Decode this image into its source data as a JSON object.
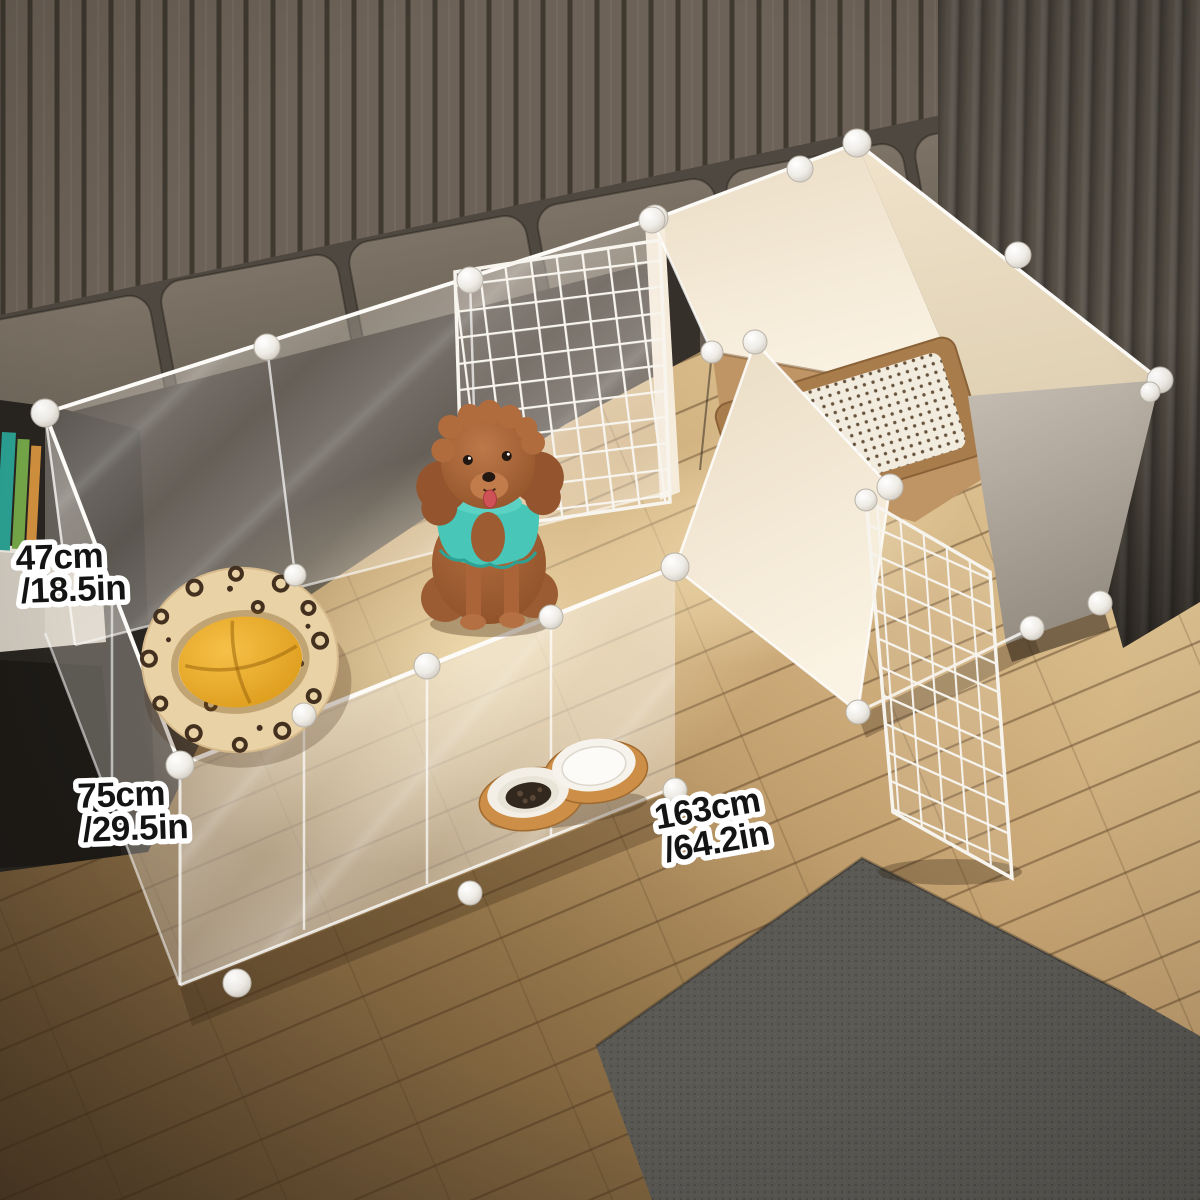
{
  "annotations": {
    "height": {
      "line1": "47cm",
      "line2": "/18.5in"
    },
    "depth": {
      "line1": "75cm",
      "line2": "/29.5in"
    },
    "width": {
      "line1": "163cm",
      "line2": "/64.2in"
    }
  },
  "colors": {
    "label_text": "#141414",
    "label_outline": "#ffffff",
    "wall_slat": "#6d6257",
    "curtain": "#564f46",
    "rug_gray": "#5b5954",
    "panel_cream": "#f3e9d8",
    "mesh_white": "#f7f4ee",
    "litter_tray_brown": "#a97c4b",
    "sweater_teal": "#48c6b8",
    "bed_cushion_orange": "#eeb23c",
    "dog_fur_brown": "#b06a3d",
    "wood_floor": "#c7a473"
  }
}
